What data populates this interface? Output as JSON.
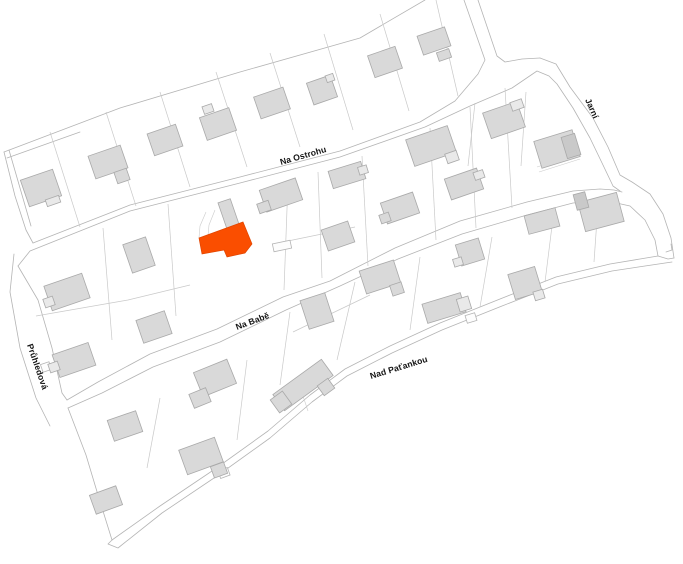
{
  "map": {
    "colors": {
      "background": "#ffffff",
      "highlight": "#fa4e00",
      "highlight_stroke": "#e04500",
      "building_fill": "#d9d9d9",
      "building_stroke": "#a9a9a9",
      "annex_fill": "#e9e9e9",
      "annex_dark": "#c9c9c9",
      "outline": "#b4b4b4",
      "parcel": "#c9c9c9",
      "detail": "#cccccc",
      "shed_fill": "#fdfdfd",
      "label": "#141414"
    },
    "street_labels": [
      {
        "text": "Na Ostrohu",
        "x": 281,
        "y": 165,
        "rotate": -16,
        "size": 8.6
      },
      {
        "text": "Jarní",
        "x": 585,
        "y": 100,
        "rotate": 66,
        "size": 8.6
      },
      {
        "text": "Na Babě",
        "x": 237,
        "y": 330,
        "rotate": -20.5,
        "size": 8.6
      },
      {
        "text": "Průhledová",
        "x": 27,
        "y": 345,
        "rotate": 71,
        "size": 8.6
      },
      {
        "text": "Nad Paťankou",
        "x": 371,
        "y": 379,
        "rotate": -17,
        "size": 8.6
      }
    ],
    "outlines": [
      [
        [
          4,
          152
        ],
        [
          120,
          108
        ],
        [
          240,
          72
        ],
        [
          360,
          38
        ],
        [
          425,
          0
        ]
      ],
      [
        [
          7,
          158
        ],
        [
          80,
          132
        ]
      ],
      [
        [
          4,
          152
        ],
        [
          15,
          196
        ],
        [
          26,
          230
        ],
        [
          33,
          243
        ]
      ],
      [
        [
          9,
          150
        ],
        [
          31,
          226
        ]
      ],
      [
        [
          33,
          243
        ],
        [
          130,
          205
        ],
        [
          240,
          177
        ],
        [
          340,
          151
        ],
        [
          420,
          122
        ],
        [
          455,
          101
        ],
        [
          478,
          74
        ],
        [
          485,
          60
        ],
        [
          464,
          0
        ]
      ],
      [
        [
          478,
          0
        ],
        [
          497,
          56
        ],
        [
          505,
          62
        ],
        [
          522,
          59
        ],
        [
          540,
          58
        ]
      ],
      [
        [
          18,
          266
        ],
        [
          30,
          251
        ],
        [
          130,
          211
        ],
        [
          240,
          183
        ],
        [
          340,
          157
        ],
        [
          425,
          127
        ],
        [
          470,
          106
        ],
        [
          512,
          88
        ],
        [
          537,
          71
        ],
        [
          549,
          76
        ],
        [
          557,
          84
        ],
        [
          573,
          108
        ],
        [
          590,
          138
        ],
        [
          603,
          165
        ],
        [
          613,
          186
        ],
        [
          620,
          191
        ]
      ],
      [
        [
          540,
          58
        ],
        [
          556,
          64
        ],
        [
          570,
          87
        ],
        [
          593,
          118
        ],
        [
          608,
          147
        ],
        [
          620,
          175
        ],
        [
          632,
          182
        ],
        [
          650,
          194
        ],
        [
          663,
          214
        ],
        [
          671,
          238
        ],
        [
          674,
          258
        ]
      ],
      [
        [
          67,
          400
        ],
        [
          98,
          382
        ],
        [
          150,
          354
        ],
        [
          217,
          329
        ],
        [
          283,
          297
        ],
        [
          330,
          281
        ],
        [
          395,
          248
        ],
        [
          460,
          221
        ],
        [
          527,
          202
        ],
        [
          573,
          191
        ],
        [
          600,
          189
        ],
        [
          614,
          190
        ],
        [
          622,
          192
        ]
      ],
      [
        [
          18,
          266
        ],
        [
          38,
          300
        ],
        [
          52,
          348
        ],
        [
          62,
          393
        ],
        [
          67,
          400
        ]
      ],
      [
        [
          14,
          254
        ],
        [
          10,
          292
        ],
        [
          20,
          348
        ],
        [
          36,
          398
        ],
        [
          50,
          426
        ]
      ],
      [
        [
          68,
          408
        ],
        [
          102,
          393
        ],
        [
          153,
          367
        ],
        [
          220,
          342
        ],
        [
          286,
          310
        ],
        [
          340,
          286
        ],
        [
          398,
          259
        ],
        [
          462,
          234
        ],
        [
          527,
          215
        ],
        [
          573,
          203
        ],
        [
          600,
          201
        ],
        [
          612,
          202
        ],
        [
          630,
          206
        ],
        [
          645,
          220
        ],
        [
          655,
          240
        ],
        [
          658,
          256
        ]
      ],
      [
        [
          658,
          256
        ],
        [
          640,
          259
        ],
        [
          610,
          264
        ],
        [
          556,
          277
        ],
        [
          500,
          299
        ],
        [
          440,
          323
        ],
        [
          390,
          346
        ],
        [
          345,
          369
        ],
        [
          310,
          395
        ],
        [
          268,
          431
        ],
        [
          215,
          469
        ],
        [
          160,
          506
        ],
        [
          112,
          540
        ]
      ],
      [
        [
          68,
          408
        ],
        [
          86,
          455
        ],
        [
          98,
          495
        ],
        [
          112,
          540
        ]
      ],
      [
        [
          672,
          262
        ],
        [
          645,
          266
        ],
        [
          612,
          271
        ],
        [
          558,
          284
        ],
        [
          502,
          306
        ],
        [
          442,
          330
        ],
        [
          392,
          353
        ],
        [
          347,
          376
        ],
        [
          312,
          402
        ],
        [
          270,
          438
        ],
        [
          217,
          476
        ],
        [
          162,
          513
        ],
        [
          118,
          548
        ],
        [
          108,
          544
        ],
        [
          112,
          540
        ]
      ],
      [
        [
          666,
          252
        ],
        [
          672,
          250
        ],
        [
          671,
          244
        ]
      ],
      [
        [
          658,
          256
        ],
        [
          668,
          259
        ],
        [
          674,
          258
        ]
      ]
    ],
    "parcels": [
      [
        [
          50,
          132
        ],
        [
          80,
          227
        ]
      ],
      [
        [
          106,
          112
        ],
        [
          136,
          206
        ]
      ],
      [
        [
          160,
          92
        ],
        [
          190,
          187
        ]
      ],
      [
        [
          216,
          72
        ],
        [
          247,
          167
        ]
      ],
      [
        [
          270,
          53
        ],
        [
          300,
          147
        ]
      ],
      [
        [
          324,
          34
        ],
        [
          353,
          130
        ]
      ],
      [
        [
          380,
          14
        ],
        [
          409,
          111
        ]
      ],
      [
        [
          436,
          0
        ],
        [
          458,
          96
        ]
      ],
      [
        [
          103,
          228
        ],
        [
          112,
          340
        ]
      ],
      [
        [
          168,
          204
        ],
        [
          176,
          316
        ]
      ],
      [
        [
          288,
          182
        ],
        [
          284,
          290
        ]
      ],
      [
        [
          318,
          172
        ],
        [
          322,
          278
        ]
      ],
      [
        [
          362,
          156
        ],
        [
          368,
          266
        ]
      ],
      [
        [
          430,
          128
        ],
        [
          436,
          240
        ]
      ],
      [
        [
          470,
          107
        ],
        [
          476,
          228
        ]
      ],
      [
        [
          505,
          88
        ],
        [
          512,
          208
        ]
      ],
      [
        [
          526,
          92
        ],
        [
          521,
          166
        ]
      ],
      [
        [
          475,
          103
        ],
        [
          468,
          166
        ]
      ],
      [
        [
          36,
          316
        ],
        [
          128,
          300
        ],
        [
          190,
          285
        ]
      ],
      [
        [
          283,
          242
        ],
        [
          322,
          234
        ],
        [
          355,
          227
        ]
      ],
      [
        [
          160,
          398
        ],
        [
          147,
          468
        ]
      ],
      [
        [
          247,
          360
        ],
        [
          237,
          440
        ]
      ],
      [
        [
          290,
          312
        ],
        [
          280,
          385
        ]
      ],
      [
        [
          355,
          282
        ],
        [
          337,
          360
        ]
      ],
      [
        [
          420,
          257
        ],
        [
          410,
          330
        ]
      ],
      [
        [
          492,
          237
        ],
        [
          480,
          307
        ]
      ],
      [
        [
          553,
          218
        ],
        [
          545,
          282
        ]
      ],
      [
        [
          598,
          205
        ],
        [
          594,
          262
        ]
      ],
      [
        [
          293,
          332
        ],
        [
          370,
          295
        ]
      ]
    ],
    "details": [
      [
        [
          206,
          212
        ],
        [
          200,
          226
        ],
        [
          199,
          238
        ]
      ],
      [
        [
          215,
          210
        ],
        [
          209,
          225
        ],
        [
          208,
          236
        ]
      ],
      [
        [
          537,
          167
        ],
        [
          578,
          154
        ]
      ],
      [
        [
          539,
          172
        ],
        [
          580,
          159
        ]
      ],
      [
        [
          303,
          396
        ],
        [
          308,
          411
        ]
      ]
    ],
    "sheds": [
      {
        "cx": 282,
        "cy": 246,
        "w": 18,
        "h": 8,
        "a": -12
      },
      {
        "cx": 46,
        "cy": 367,
        "w": 9,
        "h": 8,
        "a": -19
      },
      {
        "cx": 471,
        "cy": 318,
        "w": 10,
        "h": 8,
        "a": -17
      },
      {
        "cx": 224,
        "cy": 473,
        "w": 10,
        "h": 8,
        "a": -20
      }
    ],
    "buildings": [
      {
        "cx": 41,
        "cy": 188,
        "w": 34,
        "h": 28,
        "a": -19
      },
      {
        "cx": 53,
        "cy": 201,
        "w": 14,
        "h": 7,
        "a": -19,
        "f": "l"
      },
      {
        "cx": 108,
        "cy": 162,
        "w": 34,
        "h": 24,
        "a": -19
      },
      {
        "cx": 122,
        "cy": 176,
        "w": 13,
        "h": 12,
        "a": -19
      },
      {
        "cx": 165,
        "cy": 140,
        "w": 30,
        "h": 23,
        "a": -19
      },
      {
        "cx": 218,
        "cy": 124,
        "w": 31,
        "h": 24,
        "a": -19
      },
      {
        "cx": 208,
        "cy": 109,
        "w": 10,
        "h": 8,
        "a": -19,
        "f": "l"
      },
      {
        "cx": 272,
        "cy": 103,
        "w": 31,
        "h": 23,
        "a": -19
      },
      {
        "cx": 322,
        "cy": 90,
        "w": 25,
        "h": 23,
        "a": -19
      },
      {
        "cx": 330,
        "cy": 78,
        "w": 8,
        "h": 7,
        "a": -19,
        "f": "l"
      },
      {
        "cx": 385,
        "cy": 62,
        "w": 29,
        "h": 23,
        "a": -19
      },
      {
        "cx": 434,
        "cy": 41,
        "w": 29,
        "h": 20,
        "a": -19
      },
      {
        "cx": 444,
        "cy": 55,
        "w": 13,
        "h": 9,
        "a": -19
      },
      {
        "cx": 504,
        "cy": 120,
        "w": 36,
        "h": 27,
        "a": -19
      },
      {
        "cx": 517,
        "cy": 105,
        "w": 12,
        "h": 9,
        "a": -19,
        "f": "l"
      },
      {
        "cx": 557,
        "cy": 149,
        "w": 40,
        "h": 28,
        "a": -17
      },
      {
        "cx": 571,
        "cy": 146,
        "w": 14,
        "h": 22,
        "a": -17,
        "f": "d"
      },
      {
        "cx": 431,
        "cy": 146,
        "w": 44,
        "h": 28,
        "a": -19
      },
      {
        "cx": 452,
        "cy": 157,
        "w": 12,
        "h": 10,
        "a": -19,
        "f": "l"
      },
      {
        "cx": 464,
        "cy": 184,
        "w": 34,
        "h": 22,
        "a": -19
      },
      {
        "cx": 479,
        "cy": 175,
        "w": 10,
        "h": 8,
        "a": -19,
        "f": "l"
      },
      {
        "cx": 400,
        "cy": 208,
        "w": 34,
        "h": 22,
        "a": -19
      },
      {
        "cx": 385,
        "cy": 218,
        "w": 10,
        "h": 9,
        "a": -19
      },
      {
        "cx": 542,
        "cy": 221,
        "w": 32,
        "h": 19,
        "a": -15
      },
      {
        "cx": 601,
        "cy": 212,
        "w": 40,
        "h": 30,
        "a": -15
      },
      {
        "cx": 581,
        "cy": 201,
        "w": 12,
        "h": 16,
        "a": -15,
        "f": "d"
      },
      {
        "cx": 139,
        "cy": 255,
        "w": 24,
        "h": 30,
        "a": -19
      },
      {
        "cx": 229,
        "cy": 215,
        "w": 13,
        "h": 30,
        "a": -19
      },
      {
        "cx": 281,
        "cy": 195,
        "w": 38,
        "h": 23,
        "a": -19
      },
      {
        "cx": 264,
        "cy": 207,
        "w": 12,
        "h": 10,
        "a": -19
      },
      {
        "cx": 67,
        "cy": 292,
        "w": 40,
        "h": 26,
        "a": -19
      },
      {
        "cx": 49,
        "cy": 302,
        "w": 10,
        "h": 9,
        "a": -19,
        "f": "l"
      },
      {
        "cx": 74,
        "cy": 360,
        "w": 38,
        "h": 24,
        "a": -19
      },
      {
        "cx": 54,
        "cy": 367,
        "w": 10,
        "h": 9,
        "a": -19,
        "f": "l"
      },
      {
        "cx": 154,
        "cy": 327,
        "w": 30,
        "h": 24,
        "a": -19
      },
      {
        "cx": 347,
        "cy": 175,
        "w": 34,
        "h": 18,
        "a": -17
      },
      {
        "cx": 363,
        "cy": 170,
        "w": 9,
        "h": 8,
        "a": -17,
        "f": "l"
      },
      {
        "cx": 338,
        "cy": 236,
        "w": 28,
        "h": 22,
        "a": -19
      },
      {
        "cx": 470,
        "cy": 252,
        "w": 24,
        "h": 22,
        "a": -17
      },
      {
        "cx": 458,
        "cy": 262,
        "w": 9,
        "h": 8,
        "a": -17,
        "f": "l"
      },
      {
        "cx": 317,
        "cy": 311,
        "w": 26,
        "h": 30,
        "a": -18
      },
      {
        "cx": 525,
        "cy": 283,
        "w": 28,
        "h": 26,
        "a": -17
      },
      {
        "cx": 539,
        "cy": 295,
        "w": 10,
        "h": 9,
        "a": -17,
        "f": "l"
      },
      {
        "cx": 125,
        "cy": 426,
        "w": 30,
        "h": 22,
        "a": -19
      },
      {
        "cx": 215,
        "cy": 378,
        "w": 36,
        "h": 26,
        "a": -22
      },
      {
        "cx": 200,
        "cy": 398,
        "w": 18,
        "h": 15,
        "a": -22
      },
      {
        "cx": 303,
        "cy": 385,
        "w": 60,
        "h": 20,
        "a": -36
      },
      {
        "cx": 281,
        "cy": 402,
        "w": 15,
        "h": 16,
        "a": -36
      },
      {
        "cx": 326,
        "cy": 387,
        "w": 13,
        "h": 12,
        "a": -36
      },
      {
        "cx": 380,
        "cy": 277,
        "w": 36,
        "h": 24,
        "a": -18
      },
      {
        "cx": 397,
        "cy": 289,
        "w": 12,
        "h": 11,
        "a": -18
      },
      {
        "cx": 444,
        "cy": 308,
        "w": 40,
        "h": 20,
        "a": -17
      },
      {
        "cx": 464,
        "cy": 304,
        "w": 12,
        "h": 13,
        "a": -17,
        "f": "l"
      },
      {
        "cx": 201,
        "cy": 456,
        "w": 38,
        "h": 26,
        "a": -20
      },
      {
        "cx": 219,
        "cy": 470,
        "w": 14,
        "h": 12,
        "a": -20
      },
      {
        "cx": 106,
        "cy": 500,
        "w": 28,
        "h": 20,
        "a": -20
      }
    ],
    "highlight": {
      "points": [
        [
          199,
          238
        ],
        [
          243,
          222
        ],
        [
          252,
          244
        ],
        [
          245,
          253
        ],
        [
          227,
          257
        ],
        [
          224,
          250
        ],
        [
          202,
          254
        ]
      ]
    }
  }
}
